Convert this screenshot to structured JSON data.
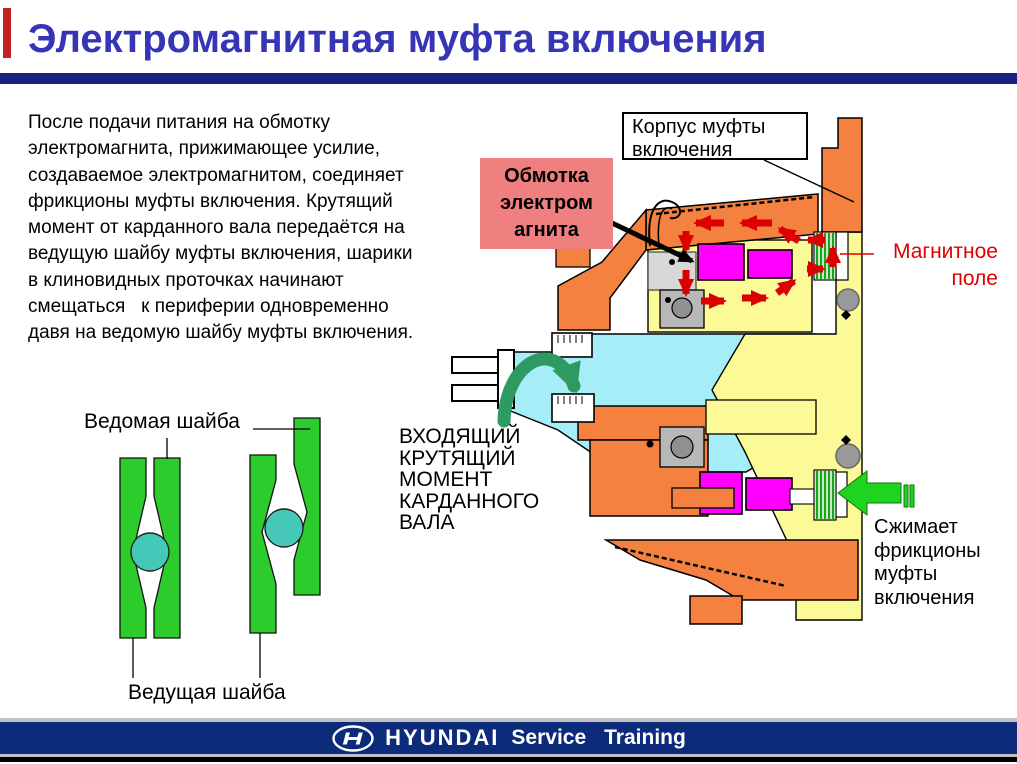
{
  "slide": {
    "title": "Электромагнитная муфта включения",
    "body_lines": [
      "После подачи питания на обмотку",
      "электромагнита, прижимающее усилие,",
      "создаваемое электромагнитом, соединяет",
      "фрикционы муфты включения. Крутящий",
      "момент от карданного вала передаётся на",
      "ведущую шайбу муфты включения, шарики",
      "в клиновидных проточках начинают",
      "смещаться   к периферии одновременно",
      "давя на ведомую шайбу муфты включения."
    ]
  },
  "cross_section": {
    "housing_label_lines": [
      "Корпус муфты",
      "включения"
    ],
    "coil_label_lines": [
      "Обмотка",
      "электром",
      "агнита"
    ],
    "magnetic_field_lines": [
      "Магнитное",
      "поле"
    ],
    "input_torque_lines": [
      "ВХОДЯЩИЙ",
      "КРУТЯЩИЙ",
      "МОМЕНТ",
      "КАРДАННОГО",
      "ВАЛА"
    ],
    "compress_lines": [
      "Сжимает",
      "фрикционы",
      "муфты",
      "включения"
    ]
  },
  "washer_diagram": {
    "driven_washer_label": "Ведомая шайба",
    "driving_washer_label": "Ведущая шайба"
  },
  "footer": {
    "brand": "HYUNDAI",
    "service_label": "Service",
    "training_label": "Training",
    "logo_icon": "hyundai-h-oval-logo"
  },
  "colors": {
    "title_text": "#3535B5",
    "title_rule_navy": "#18227E",
    "accent_red_bar": "#C22222",
    "coil_label_bg": "#F08080",
    "magnetic_field_text": "#E00000",
    "arrow_red": "#DD0000",
    "housing_orange": "#F4813F",
    "chamber_yellow": "#FBFA96",
    "coil_magenta": "#FF00FF",
    "shaft_cyan": "#A6EEF7",
    "plate_green": "#2DCC2D",
    "ball_teal": "#45C8B8",
    "rotation_arrow_green": "#2E9960",
    "compress_arrow_green": "#1ED41E",
    "footer_navy": "#0D2B7B"
  }
}
